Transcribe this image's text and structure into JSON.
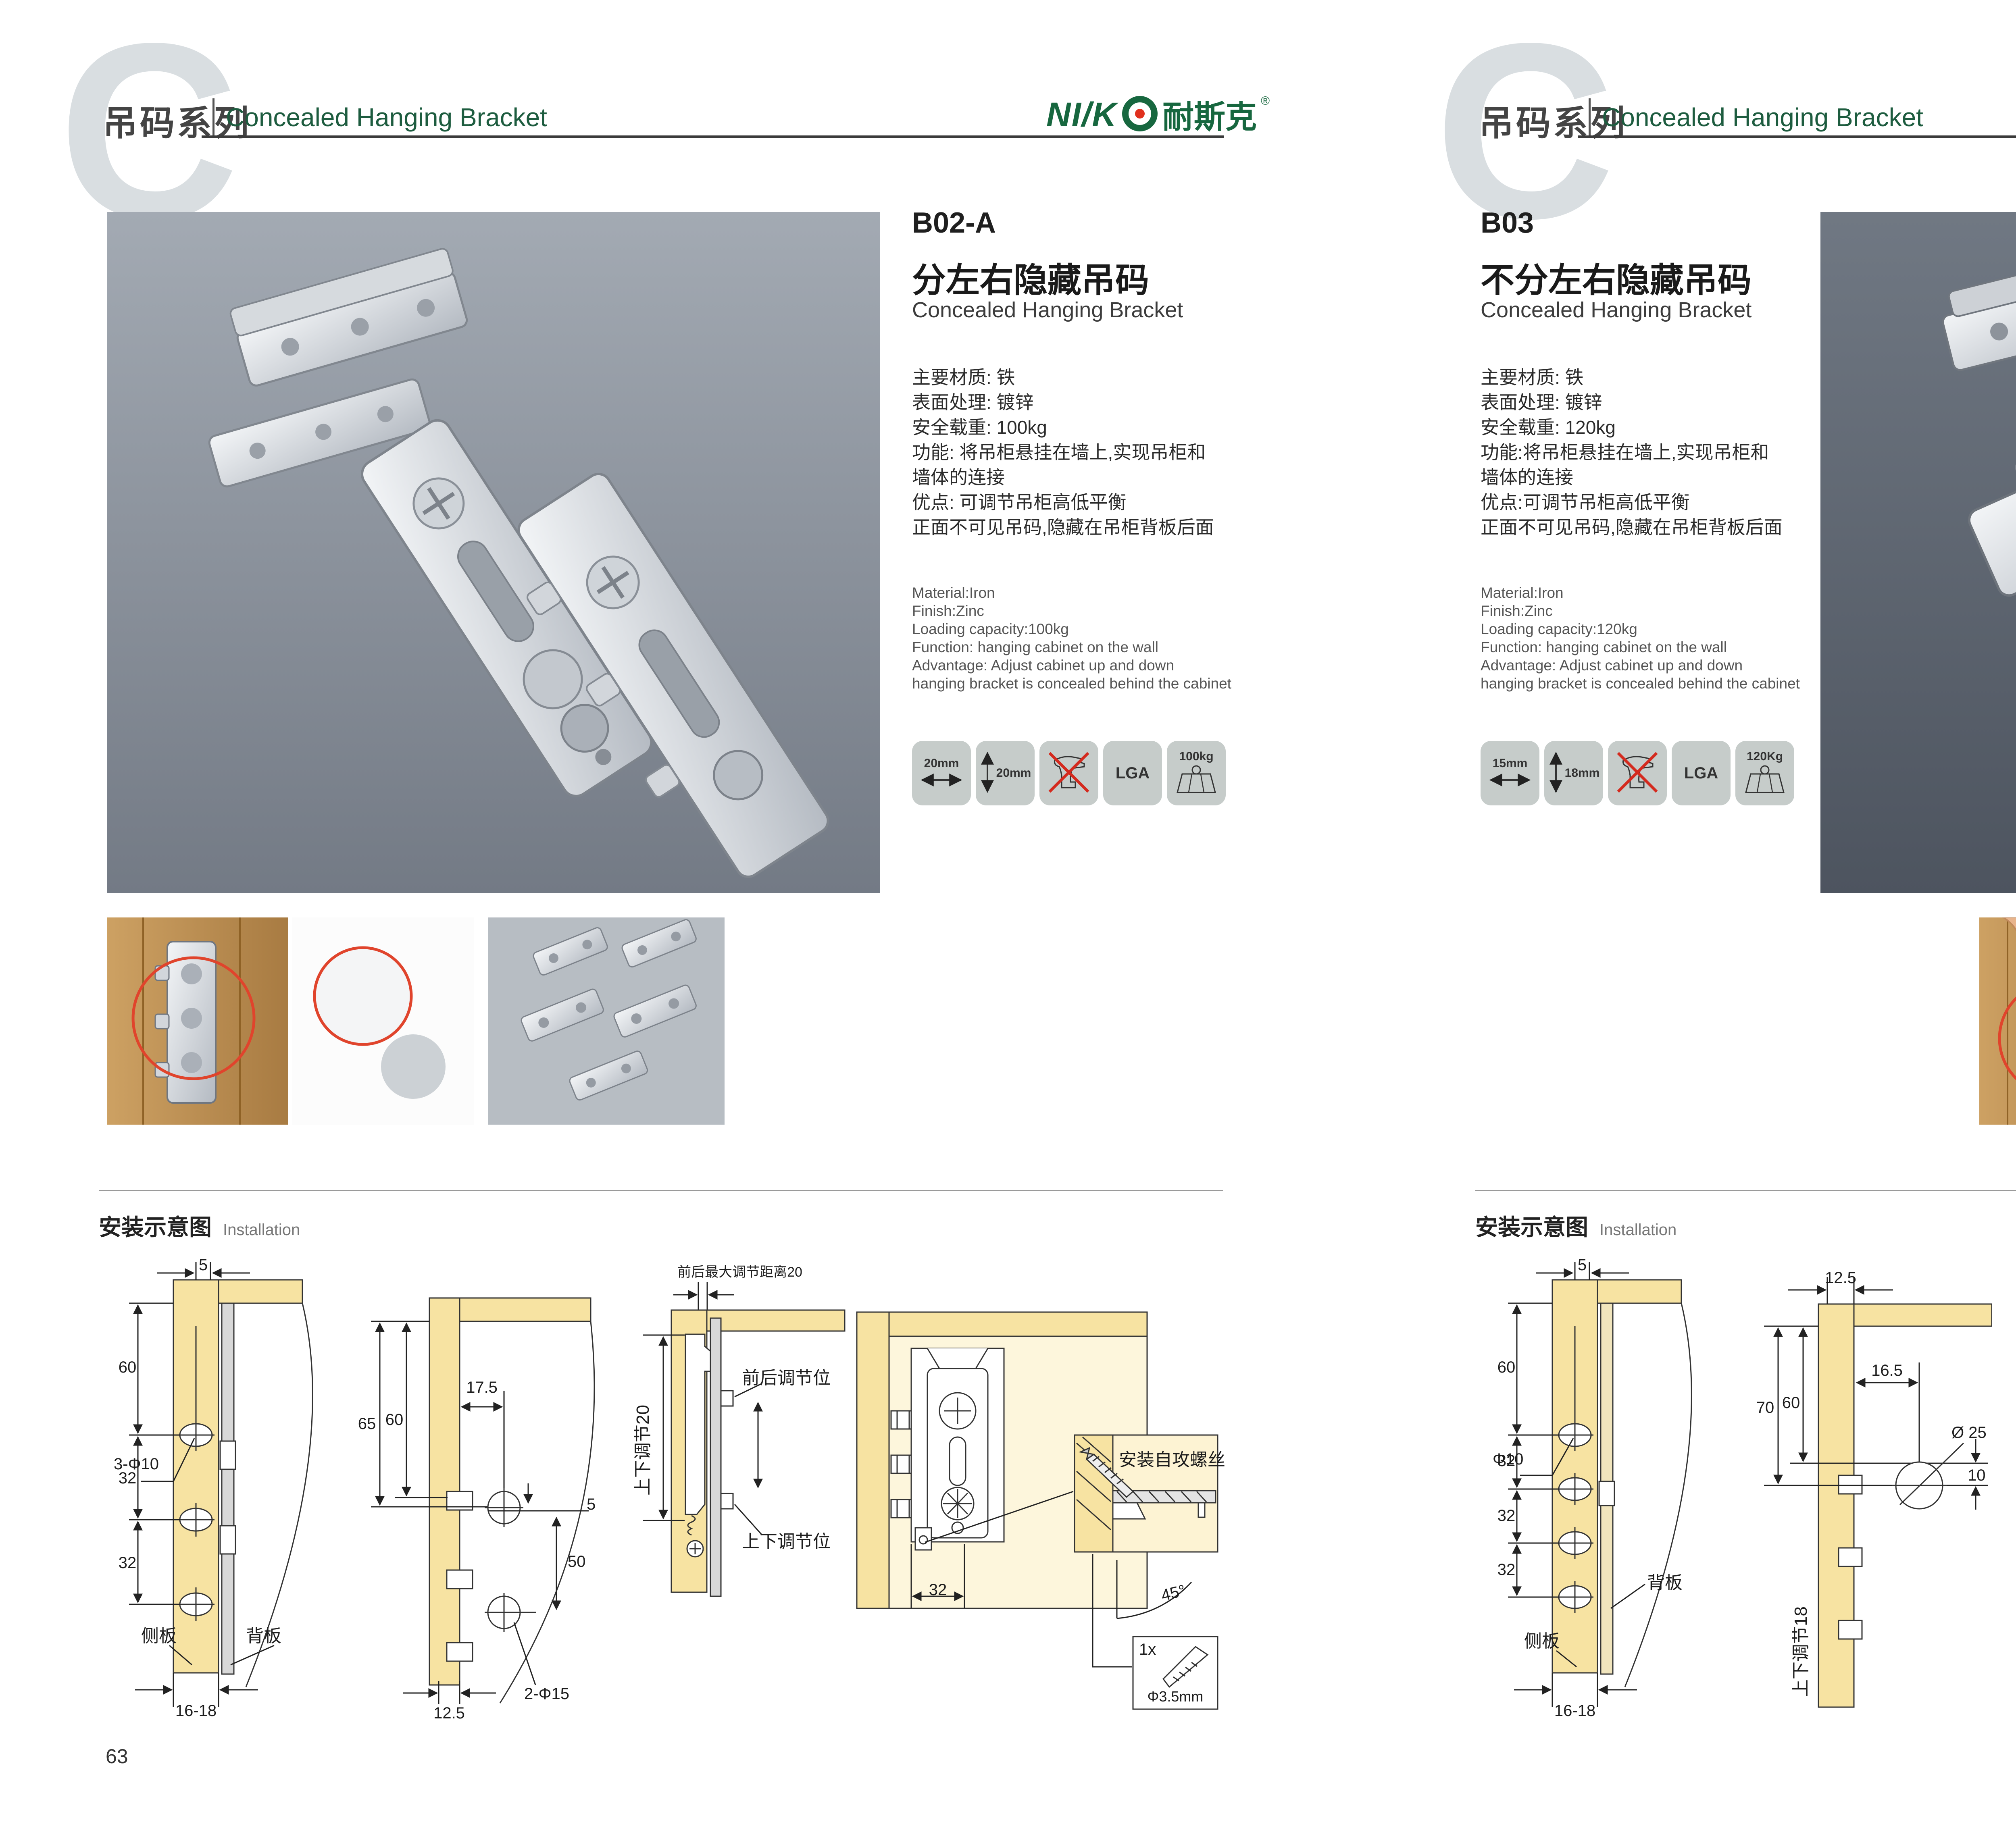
{
  "header": {
    "watermark": "C",
    "series_cjk": "吊码系列",
    "series_en": "Concealed Hanging Bracket",
    "brand": {
      "latin_prefix": "NI/K",
      "target_letter": "O",
      "cjk": "耐斯克",
      "registered": "®"
    },
    "accent_green": "#17673f",
    "accent_red": "#e0301e"
  },
  "pages": [
    {
      "page_number": "63",
      "product": {
        "code": "B02-A",
        "name_cjk": "分左右隐藏吊码",
        "name_en": "Concealed Hanging Bracket",
        "specs_cjk": [
          "主要材质: 铁",
          "表面处理: 镀锌",
          "安全载重: 100kg",
          "功能: 将吊柜悬挂在墙上,实现吊柜和",
          "墙体的连接",
          "优点: 可调节吊柜高低平衡",
          "正面不可见吊码,隐藏在吊柜背板后面"
        ],
        "specs_en": [
          "Material:Iron",
          "Finish:Zinc",
          "Loading capacity:100kg",
          "Function: hanging cabinet on the wall",
          "Advantage: Adjust cabinet up and down",
          "hanging bracket is concealed behind the cabinet"
        ],
        "badges": [
          {
            "icon": "arrow-horizontal",
            "label": "20mm"
          },
          {
            "icon": "arrow-vertical",
            "label": "20mm"
          },
          {
            "icon": "no-drill",
            "label": ""
          },
          {
            "icon": "lga",
            "label": "LGA"
          },
          {
            "icon": "weight",
            "label": "100kg"
          }
        ]
      },
      "installation": {
        "heading_cjk": "安装示意图",
        "heading_en": "Installation",
        "d1": {
          "dim_top": "5",
          "dim1": "60",
          "hole": "3-Φ10",
          "dim2": "32",
          "dim3": "32",
          "dim_bottom": "16-18",
          "side": "侧板",
          "back": "背板"
        },
        "d2": {
          "dim_outer": "65",
          "dim_inner": "60",
          "dim_top": "17.5",
          "dim_gap": "5",
          "dim_span": "50",
          "hole": "2-Φ15",
          "dim_bottom": "12.5"
        },
        "d3": {
          "top": "前后最大调节距离20",
          "left": "上下调节20",
          "front": "前后调节位",
          "updown": "上下调节位"
        },
        "d4": {
          "dim": "32",
          "inset": "安装自攻螺丝",
          "angle": "45°",
          "qty": "1x",
          "dia": "Φ3.5mm"
        }
      }
    },
    {
      "page_number": "64",
      "product": {
        "code": "B03",
        "name_cjk": "不分左右隐藏吊码",
        "name_en": "Concealed Hanging Bracket",
        "specs_cjk": [
          "主要材质: 铁",
          "表面处理: 镀锌",
          "安全载重: 120kg",
          "功能:将吊柜悬挂在墙上,实现吊柜和",
          "墙体的连接",
          "优点:可调节吊柜高低平衡",
          "正面不可见吊码,隐藏在吊柜背板后面"
        ],
        "specs_en": [
          "Material:Iron",
          "Finish:Zinc",
          "Loading capacity:120kg",
          "Function: hanging cabinet on the wall",
          "Advantage: Adjust cabinet up and down",
          "hanging bracket is concealed behind the cabinet"
        ],
        "badges": [
          {
            "icon": "arrow-horizontal",
            "label": "15mm"
          },
          {
            "icon": "arrow-vertical",
            "label": "18mm"
          },
          {
            "icon": "no-drill",
            "label": ""
          },
          {
            "icon": "lga",
            "label": "LGA"
          },
          {
            "icon": "weight",
            "label": "120Kg"
          }
        ]
      },
      "installation": {
        "heading_cjk": "安装示意图",
        "heading_en": "Installation",
        "d1": {
          "dim_top": "5",
          "dim1": "60",
          "hole": "Φ10",
          "dim2": "32",
          "dim3": "32",
          "dim4": "32",
          "dim_bottom": "16-18",
          "side": "侧板",
          "back": "背板"
        },
        "d2": {
          "dim_top": "12.5",
          "dim_outer": "70",
          "dim_inner": "60",
          "dim_inner_top": "16.5",
          "hole": "Ø 25",
          "dim_offset": "10",
          "rot": "上下调节18"
        },
        "d3": {
          "dim_top": "16.5",
          "dim_left": "12.5",
          "dim_offset": "10",
          "hole": "ø25",
          "lock": "锁紧状态"
        },
        "d4": {
          "inset": "安装自攻螺丝",
          "angle": "45°",
          "qty": "1x",
          "dia": "Φ3.5mm"
        }
      }
    }
  ]
}
